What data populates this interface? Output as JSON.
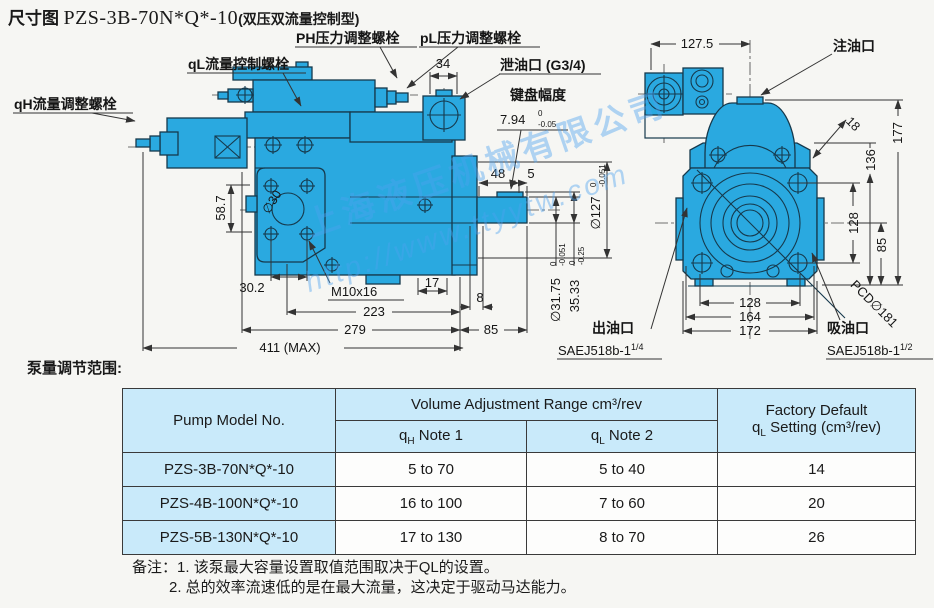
{
  "title": {
    "prefix": "尺寸图",
    "model": "PZS-3B-70N*Q*-10",
    "suffix": "(双压双流量控制型)"
  },
  "watermark": {
    "line1": "上海液压机械有限公司",
    "line2": "http://www.ttyytw.com"
  },
  "colors": {
    "pump_blue": "#2aa9e0",
    "table_header_bg": "#c9eafa"
  },
  "left_view": {
    "labels": {
      "ph_screw": "PH压力调整螺栓",
      "pl_screw": "pL压力调整螺栓",
      "ql_screw": "qL流量控制螺栓",
      "qh_screw": "qH流量调整螺栓",
      "drain_port": "泄油口 (G3/4)",
      "key_width": "键盘幅度",
      "key_val": "7.94",
      "key_tol_top": "0",
      "key_tol_bot": "-0.05"
    },
    "dims": {
      "d34": "34",
      "d48": "48",
      "d5": "5",
      "dia127": "∅127",
      "dia127_top": "0",
      "dia127_bot": "-0.051",
      "dia3175": "∅31.75",
      "dia3175_top": "0",
      "dia3175_bot": "-0.051",
      "d3533": "35.33",
      "d3533_top": "0",
      "d3533_bot": "-0.25",
      "d587": "58.7",
      "dia30": "∅30",
      "d302": "30.2",
      "m10": "M10x16",
      "d17": "17",
      "d8": "8",
      "d223": "223",
      "d279": "279",
      "d85": "85",
      "d411": "411 (MAX)"
    }
  },
  "right_view": {
    "labels": {
      "fill_port": "注油口",
      "outlet": "出油口",
      "outlet_spec": "SAEJ518b-1",
      "outlet_frac": "1/4",
      "suction": "吸油口",
      "suction_spec": "SAEJ518b-1",
      "suction_frac": "1/2",
      "pcd": "PCD∅181"
    },
    "dims": {
      "d1275": "127.5",
      "d18": "18",
      "d177": "177",
      "d136": "136",
      "d128r": "128",
      "d85": "85",
      "d128b": "128",
      "d164": "164",
      "d172": "172"
    }
  },
  "section_label": "泵量调节范围:",
  "table": {
    "h_model": "Pump Model No.",
    "h_range": "Volume Adjustment Range cm³/rev",
    "h_q1_pre": "q",
    "h_q1_sub": "H",
    "h_q1_rest": " Note 1",
    "h_q2_pre": "q",
    "h_q2_sub": "L",
    "h_q2_rest": " Note 2",
    "h_fact1": "Factory Default",
    "h_fact2_pre": "q",
    "h_fact2_sub": "L",
    "h_fact2_rest": " Setting (cm³/rev)",
    "rows": [
      {
        "model": "PZS-3B-70N*Q*-10",
        "qh": "5 to 70",
        "ql": "5 to 40",
        "def": "14"
      },
      {
        "model": "PZS-4B-100N*Q*-10",
        "qh": "16 to 100",
        "ql": "7 to 60",
        "def": "20"
      },
      {
        "model": "PZS-5B-130N*Q*-10",
        "qh": "17 to 130",
        "ql": "8 to 70",
        "def": "26"
      }
    ]
  },
  "notes": {
    "label": "备注：",
    "line1": "1. 该泵最大容量设置取值范围取决于QL的设置。",
    "line2": "2. 总的效率流速低的是在最大流量，这决定于驱动马达能力。"
  }
}
